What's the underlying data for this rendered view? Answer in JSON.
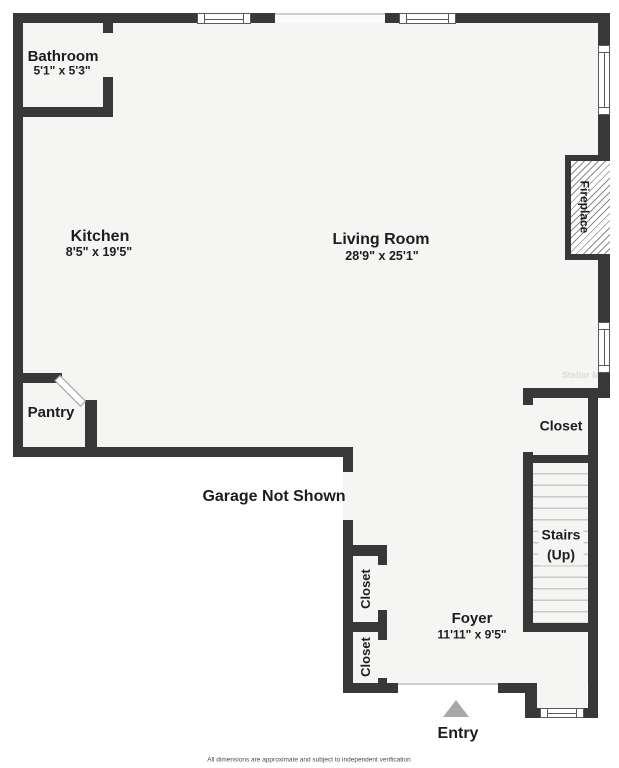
{
  "rooms": {
    "bathroom": {
      "name": "Bathroom",
      "dims": "5'1\" x 5'3\""
    },
    "kitchen": {
      "name": "Kitchen",
      "dims": "8'5\" x 19'5\""
    },
    "living_room": {
      "name": "Living Room",
      "dims": "28'9\" x 25'1\""
    },
    "pantry": {
      "name": "Pantry"
    },
    "foyer": {
      "name": "Foyer",
      "dims": "11'11\" x 9'5\""
    },
    "closet_hall": {
      "name": "Closet"
    },
    "closet_upper": {
      "name": "Closet"
    },
    "closet_lower": {
      "name": "Closet"
    },
    "stairs": {
      "name": "Stairs",
      "note": "(Up)"
    },
    "fireplace": {
      "name": "Fireplace"
    }
  },
  "annotations": {
    "garage_note": "Garage Not Shown",
    "entry_label": "Entry",
    "watermark": "Stellar MLS",
    "disclaimer": "All dimensions are approximate and subject to independent verification"
  },
  "colors": {
    "wall": "#383838",
    "floor": "#f5f5f4",
    "outside": "#ffffff",
    "entry_arrow": "#a8a8a8"
  }
}
